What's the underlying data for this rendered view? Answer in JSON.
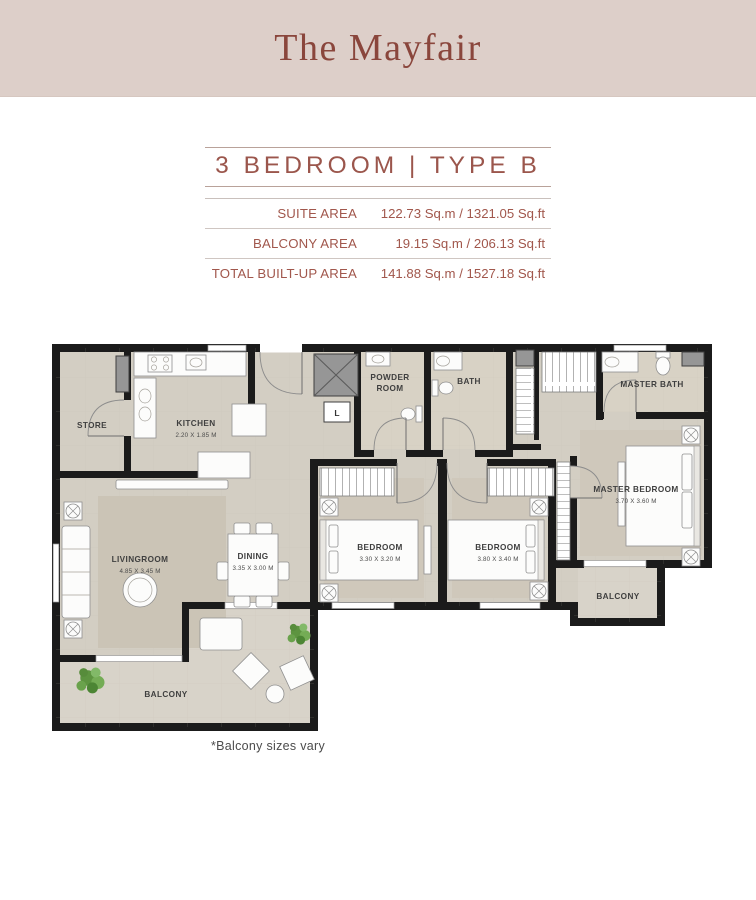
{
  "header": {
    "title": "The Mayfair"
  },
  "unit": {
    "title": "3 BEDROOM | TYPE B",
    "area_rows": [
      {
        "label": "SUITE AREA",
        "value": "122.73 Sq.m / 1321.05 Sq.ft"
      },
      {
        "label": "BALCONY AREA",
        "value": "19.15 Sq.m / 206.13 Sq.ft"
      },
      {
        "label": "TOTAL BUILT-UP AREA",
        "value": "141.88 Sq.m / 1527.18 Sq.ft"
      }
    ],
    "footnote": "*Balcony sizes vary"
  },
  "floorplan": {
    "labels": {
      "store": "STORE",
      "kitchen": "KITCHEN",
      "kitchen_dims": "2.20 X 1.85 M",
      "powder_line1": "POWDER",
      "powder_line2": "ROOM",
      "bath": "BATH",
      "master_bath": "MASTER BATH",
      "master_bedroom": "MASTER BEDROOM",
      "master_bedroom_dims": "3.70 X 3.60 M",
      "bedroom1": "BEDROOM",
      "bedroom1_dims": "3.30 X 3.20 M",
      "bedroom2": "BEDROOM",
      "bedroom2_dims": "3.80 X 3.40 M",
      "livingroom": "LIVINGROOM",
      "livingroom_dims": "4.85 X 3.45 M",
      "dining": "DINING",
      "dining_dims": "3.35 X 3.00 M",
      "balcony_right": "BALCONY",
      "balcony_bottom": "BALCONY",
      "lift": "L"
    },
    "colors": {
      "wall": "#1b1b1b",
      "floor": "#d3cec3",
      "carpet": "#cfc8bb",
      "rug": "#cbc4b6",
      "bath_floor": "#d8d2c5",
      "balcony_floor": "#d8d3c9",
      "plant_green": "#6aa24c",
      "header_bg": "#ddcfc9",
      "brand_maroon": "#8a463c",
      "table_text": "#a1574c"
    }
  }
}
